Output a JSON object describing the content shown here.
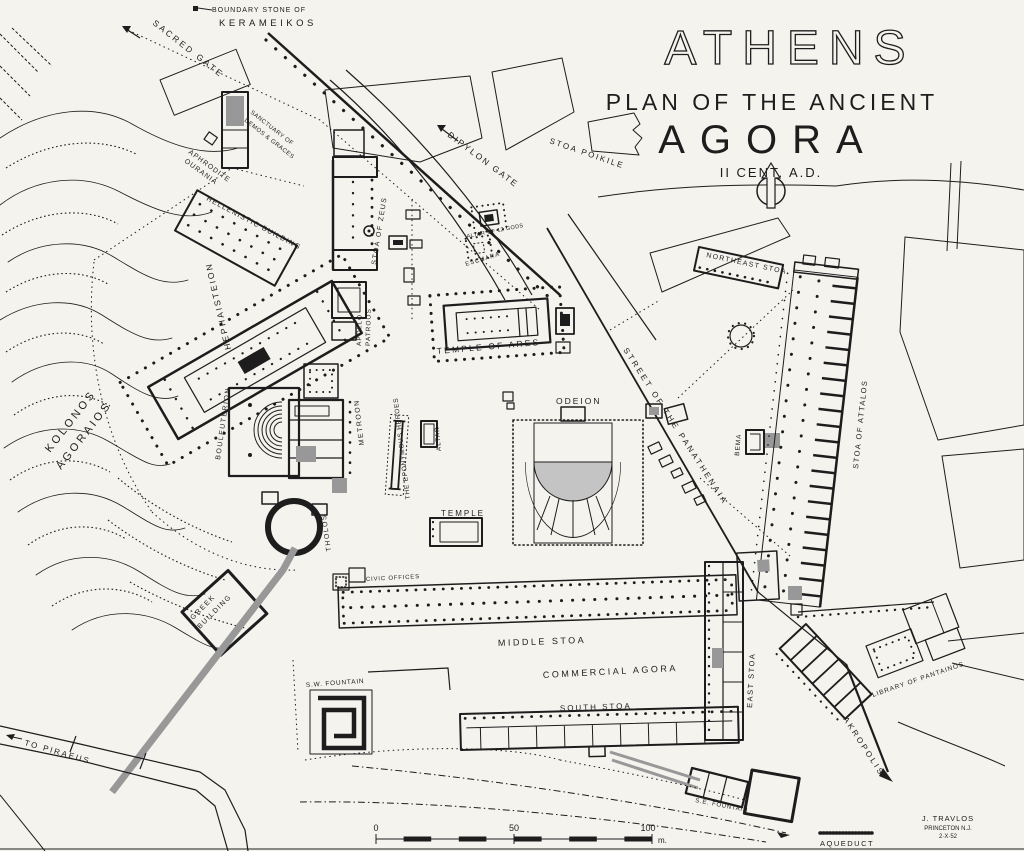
{
  "colors": {
    "paper": "#f5f3ee",
    "ink": "#1d1d1d",
    "road_gray": "#989898",
    "shade_gray": "#c9c9c9"
  },
  "title": {
    "city": "ATHENS",
    "subtitle": "PLAN OF THE ANCIENT",
    "name": "AGORA",
    "period": "II CENT. A.D."
  },
  "labels": {
    "boundary_stone_of": "BOUNDARY STONE OF",
    "kerameikos": "KERAMEIKOS",
    "sacred_gate": "SACRED GATE",
    "dipylon_gate": "DIPYLON GATE",
    "stoa_poikile": "STOA POIKILE",
    "sanctuary_of": "SANCTUARY OF",
    "demos_graces": "DEMOS & GRACES",
    "aphrodite": "APHRODITE",
    "ourania": "OURANIA",
    "hellenistic_building": "HELLENISTIC BUILDING",
    "hephaisteion": "HEPHAISTEION",
    "kolonos": "KOLONOS",
    "agoraios": "AGORAIOS",
    "stoa_of_zeus": "STOA OF ZEUS",
    "apollo": "APOLLO",
    "patroos": "PATROOS",
    "altar_of_12_gods": "ALTAR OF 12 GODS",
    "eschara": "ESCHARA",
    "temple_of_ares": "TEMPLE OF ARES",
    "northeast_stoa": "NORTHEAST STOA",
    "street_of_the_panathenaia": "STREET OF THE PANATHENAIA",
    "stoa_of_attalos": "STOA OF ATTALOS",
    "odeion": "ODEION",
    "bema": "BEMA",
    "metroon": "METROON",
    "bouleuterion": "BOULEUTERION",
    "the_eponymous_heroes": "THE EPONYMOUS HEROES",
    "altar": "ALTAR",
    "tholos": "THOLOS",
    "temple": "TEMPLE",
    "civic_offices": "CIVIC OFFICES",
    "middle_stoa": "MIDDLE STOA",
    "commercial_agora": "COMMERCIAL AGORA",
    "south_stoa": "SOUTH STOA",
    "east_stoa": "EAST STOA",
    "greek": "GREEK",
    "building": "BUILDING",
    "sw_fountain": "S.W. FOUNTAIN",
    "to_piraeus": "TO PIRAEUS",
    "library_of_pantainos": "LIBRARY OF PANTAINOS",
    "akropolis": "AKROPOLIS",
    "se_fountain": "S.E. FOUNTAIN",
    "aqueduct": "AQUEDUCT"
  },
  "scale_bar": {
    "start": "0",
    "middle": "50",
    "end": "100",
    "unit": "m."
  },
  "credit": {
    "author": "J. TRAVLOS",
    "place": "PRINCETON N.J.",
    "date": "2·X·52"
  }
}
